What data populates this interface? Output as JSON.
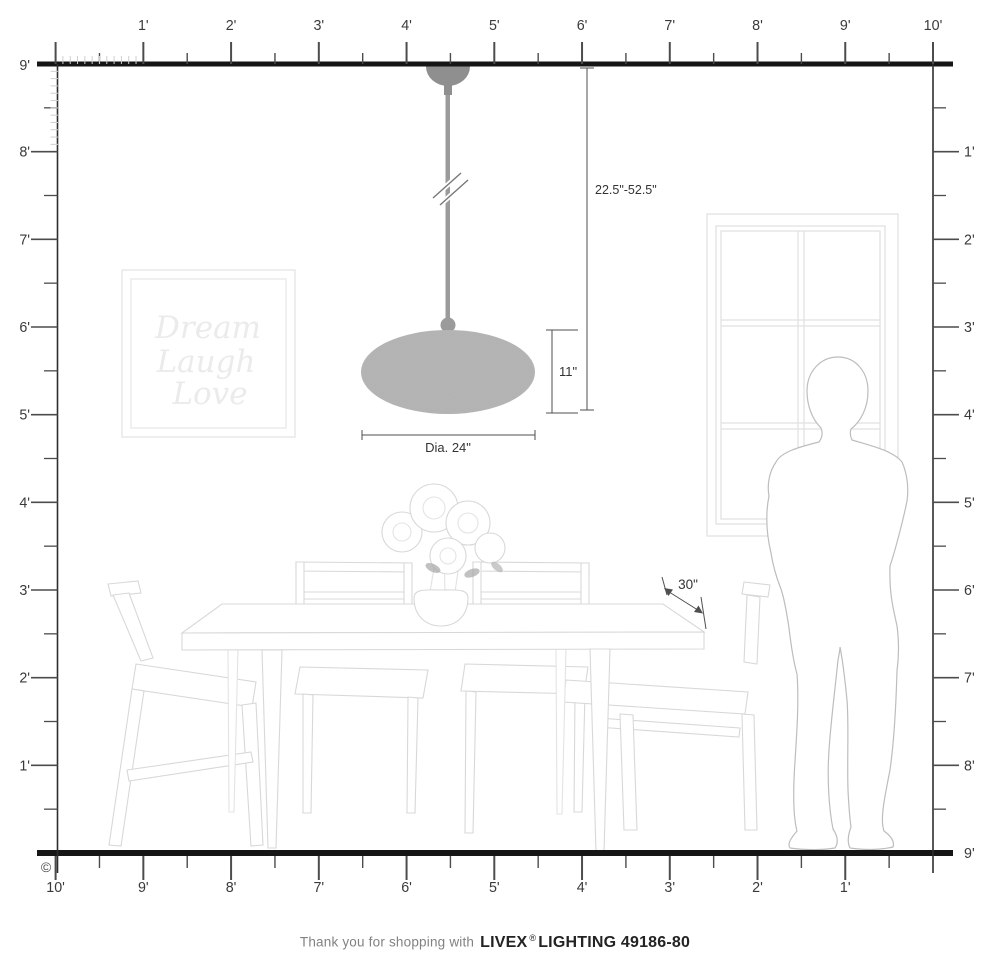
{
  "caption": {
    "prefix": "Thank you for shopping with",
    "brand": "LIVEX",
    "registered": "®",
    "suffix": "LIGHTING 49186-80"
  },
  "annotations": {
    "hanging_height": "22.5\"-52.5\"",
    "fixture_height": "11\"",
    "diameter": "Dia. 24\"",
    "table_depth": "30\""
  },
  "wall_art": {
    "line1": "Dream",
    "line2": "Laugh",
    "line3": "Love"
  },
  "copyright": "©",
  "rulers": {
    "top": {
      "labels": [
        "1'",
        "2'",
        "3'",
        "4'",
        "5'",
        "6'",
        "7'",
        "8'",
        "9'",
        "10'"
      ]
    },
    "bottom": {
      "labels": [
        "10'",
        "9'",
        "8'",
        "7'",
        "6'",
        "5'",
        "4'",
        "3'",
        "2'",
        "1'"
      ]
    },
    "left": {
      "top_label": "9'",
      "labels": [
        "8'",
        "7'",
        "6'",
        "5'",
        "4'",
        "3'",
        "2'",
        "1'"
      ]
    },
    "right": {
      "labels": [
        "1'",
        "2'",
        "3'",
        "4'",
        "5'",
        "6'",
        "7'",
        "8'",
        "9'"
      ]
    }
  },
  "colors": {
    "ruler_line": "#161616",
    "tick_major": "#4c4c4c",
    "tick_minor": "#cfcfcf",
    "ruler_label": "#3a3a3a",
    "dimension": "#4f4f4f",
    "dimension_text": "#333333",
    "furniture": "#d8d8d8",
    "person": "#bdbdbd",
    "wall_frame": "#e6e6e6",
    "window": "#e1e1e1",
    "wall_art_text": "#ebebeb",
    "pendant_hardware": "#8f8f8f",
    "pendant_rod": "#9b9b9b",
    "pendant_shade": "#b6b6b6"
  }
}
